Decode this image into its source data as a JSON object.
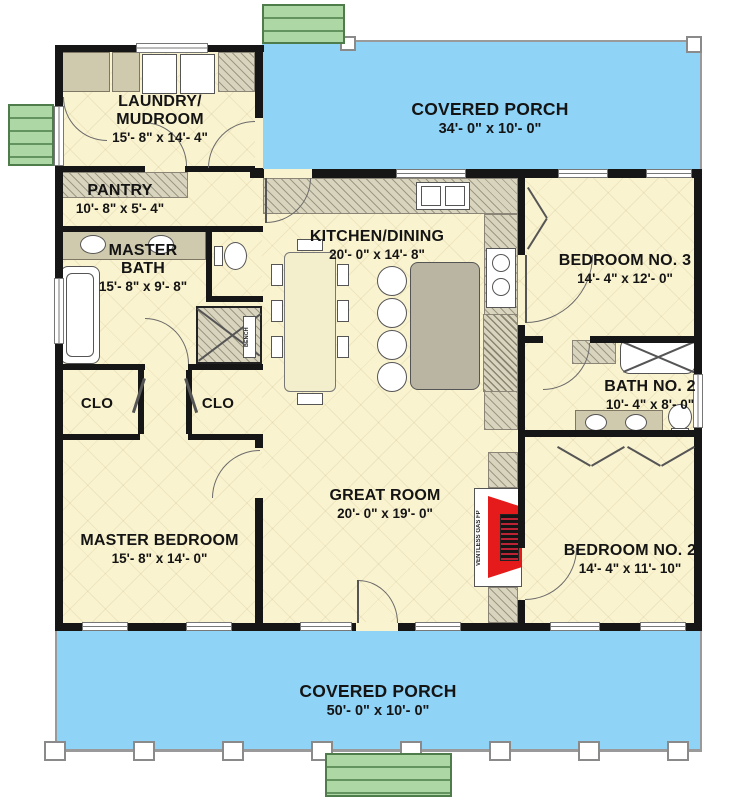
{
  "rooms": {
    "porch_top": {
      "name": "COVERED PORCH",
      "dims": "34'- 0\" x 10'- 0\""
    },
    "laundry": {
      "name": "LAUNDRY/\nMUDROOM",
      "dims": "15'- 8\" x 14'- 4\""
    },
    "pantry": {
      "name": "PANTRY",
      "dims": "10'- 8\" x 5'- 4\""
    },
    "master_bath": {
      "name": "MASTER\nBATH",
      "dims": "15'- 8\" x 9'- 8\""
    },
    "kitchen": {
      "name": "KITCHEN/DINING",
      "dims": "20'- 0\" x 14'- 8\""
    },
    "bedroom3": {
      "name": "BEDROOM NO. 3",
      "dims": "14'- 4\" x 12'- 0\""
    },
    "bath2": {
      "name": "BATH NO. 2",
      "dims": "10'- 4\" x 8'- 0\""
    },
    "clo_left": {
      "name": "CLO"
    },
    "clo_right": {
      "name": "CLO"
    },
    "great_room": {
      "name": "GREAT ROOM",
      "dims": "20'- 0\" x 19'- 0\""
    },
    "master_bedroom": {
      "name": "MASTER BEDROOM",
      "dims": "15'- 8\" x 14'- 0\""
    },
    "bedroom2": {
      "name": "BEDROOM NO. 2",
      "dims": "14'- 4\" x 11'- 10\""
    },
    "porch_bottom": {
      "name": "COVERED PORCH",
      "dims": "50'- 0\" x 10'- 0\""
    }
  },
  "fixtures": {
    "stove_hood": "ST OVEN/\nHOOD",
    "fridge": "REF.",
    "fireplace": "VENTLESS GAS FP",
    "bench": "BENCH"
  },
  "colors": {
    "porch": "#8fd3f6",
    "floor": "#faf3cf",
    "wall": "#161616",
    "stoop_green": "#aed7a6",
    "fireplace_red": "#e51a1a",
    "counter": "#d9d4bd"
  }
}
